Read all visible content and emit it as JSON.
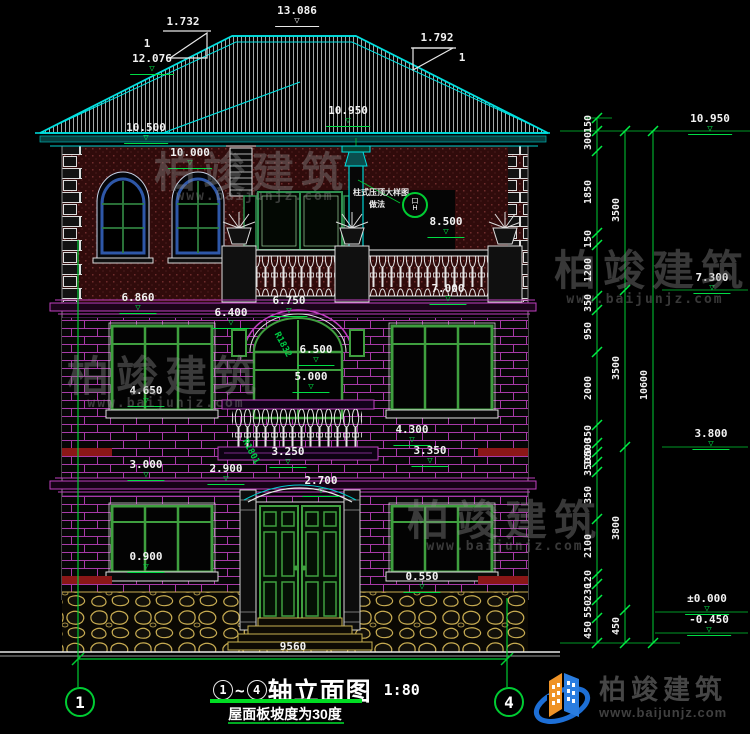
{
  "title": {
    "axis_start": "1",
    "tilde": "~",
    "axis_end": "4",
    "name": "轴立面图",
    "scale": "1:80",
    "subtitle": "屋面板坡度为30度"
  },
  "axis_bubbles": {
    "left": "1",
    "right": "4"
  },
  "watermark": {
    "name": "柏竣建筑",
    "url": "www.baijunjz.com"
  },
  "logo": {
    "name": "柏竣建筑",
    "url": "www.baijunjz.com"
  },
  "note": {
    "line1": "柱式压顶大样图",
    "line2": "做法",
    "bubble_top": "口",
    "bubble_bottom": "H"
  },
  "annotations": [
    {
      "t": "1.732",
      "x": 183,
      "y": 16,
      "c": "dim",
      "n": "slope-ratio-left"
    },
    {
      "t": "1",
      "x": 147,
      "y": 38,
      "c": "dim",
      "n": "slope-one-left"
    },
    {
      "t": "13.086",
      "x": 297,
      "y": 5,
      "c": "elev",
      "m": "w",
      "n": "ridge-elevation"
    },
    {
      "t": "1.792",
      "x": 437,
      "y": 32,
      "c": "dim",
      "n": "slope-ratio-right"
    },
    {
      "t": "1",
      "x": 462,
      "y": 52,
      "c": "dim",
      "n": "slope-one-right"
    },
    {
      "t": "12.076",
      "x": 152,
      "y": 53,
      "c": "elev",
      "n": "roof-elevation"
    },
    {
      "t": "10.950",
      "x": 348,
      "y": 105,
      "c": "elev",
      "n": "eave-elevation"
    },
    {
      "t": "10.500",
      "x": 146,
      "y": 122,
      "c": "elev",
      "n": "eave-elevation"
    },
    {
      "t": "10.000",
      "x": 190,
      "y": 147,
      "c": "elev",
      "n": "wall-top-elevation"
    },
    {
      "t": "8.500",
      "x": 446,
      "y": 216,
      "c": "elev",
      "n": "railing-elevation"
    },
    {
      "t": "7.000",
      "x": 448,
      "y": 283,
      "c": "elev",
      "n": "floor3-elevation"
    },
    {
      "t": "6.860",
      "x": 138,
      "y": 292,
      "c": "elev",
      "n": "cornice-elevation"
    },
    {
      "t": "6.750",
      "x": 289,
      "y": 295,
      "c": "elev",
      "n": "balcony-elevation"
    },
    {
      "t": "6.400",
      "x": 231,
      "y": 307,
      "c": "elev",
      "n": "window-top-elevation"
    },
    {
      "t": "6.500",
      "x": 316,
      "y": 344,
      "c": "elev",
      "n": "arch-elevation"
    },
    {
      "t": "5.000",
      "x": 311,
      "y": 371,
      "c": "elev",
      "n": "window-elevation"
    },
    {
      "t": "4.650",
      "x": 146,
      "y": 385,
      "c": "elev",
      "n": "sill-elevation"
    },
    {
      "t": "4.300",
      "x": 412,
      "y": 424,
      "c": "elev",
      "n": "sill-elevation"
    },
    {
      "t": "3.000",
      "x": 146,
      "y": 459,
      "c": "elev",
      "n": "beam-elevation"
    },
    {
      "t": "2.900",
      "x": 226,
      "y": 463,
      "c": "elev",
      "n": "beam-elevation"
    },
    {
      "t": "3.250",
      "x": 288,
      "y": 446,
      "c": "elev",
      "n": "balcony2-elevation"
    },
    {
      "t": "3.350",
      "x": 430,
      "y": 445,
      "c": "elev",
      "n": "beam-elevation"
    },
    {
      "t": "2.700",
      "x": 321,
      "y": 475,
      "c": "elev",
      "n": "door-arch-elevation"
    },
    {
      "t": "0.900",
      "x": 146,
      "y": 551,
      "c": "elev",
      "n": "sill-elevation"
    },
    {
      "t": "0.550",
      "x": 422,
      "y": 571,
      "c": "elev",
      "n": "sill-elevation"
    },
    {
      "t": "9560",
      "x": 293,
      "y": 641,
      "c": "dim",
      "n": "overall-width-dimension"
    },
    {
      "t": "R1832",
      "x": 282,
      "y": 345,
      "c": "rad",
      "r": 62,
      "n": "arch-radius-label"
    },
    {
      "t": "R1801",
      "x": 250,
      "y": 452,
      "c": "rad",
      "r": 62,
      "n": "arch-radius-label"
    },
    {
      "t": "10.950",
      "x": 710,
      "y": 113,
      "c": "elev",
      "n": "right-level-10950"
    },
    {
      "t": "7.300",
      "x": 712,
      "y": 272,
      "c": "elev",
      "n": "right-level-7300"
    },
    {
      "t": "3.800",
      "x": 711,
      "y": 428,
      "c": "elev",
      "n": "right-level-3800"
    },
    {
      "t": "±0.000",
      "x": 707,
      "y": 593,
      "c": "elev",
      "n": "right-level-zero"
    },
    {
      "t": "-0.450",
      "x": 709,
      "y": 614,
      "c": "elev",
      "n": "right-level-minus450"
    },
    {
      "t": "柏竣建筑",
      "x": 252,
      "y": 152,
      "c": "wm",
      "n": "watermark-text"
    },
    {
      "t": "www.baijunjz.com",
      "x": 255,
      "y": 190,
      "c": "wmu",
      "n": "watermark-url"
    },
    {
      "t": "柏竣建筑",
      "x": 652,
      "y": 250,
      "c": "wm",
      "n": "watermark-text"
    },
    {
      "t": "www.baijunjz.com",
      "x": 645,
      "y": 293,
      "c": "wmu",
      "n": "watermark-url"
    },
    {
      "t": "柏竣建筑",
      "x": 165,
      "y": 356,
      "c": "wm",
      "n": "watermark-text"
    },
    {
      "t": "www.baijunjz.com",
      "x": 166,
      "y": 397,
      "c": "wmu",
      "n": "watermark-url"
    },
    {
      "t": "柏竣建筑",
      "x": 505,
      "y": 500,
      "c": "wm",
      "n": "watermark-text"
    },
    {
      "t": "www.baijunjz.com",
      "x": 505,
      "y": 540,
      "c": "wmu",
      "n": "watermark-url"
    },
    {
      "t": "柱式压顶大样图",
      "x": 381,
      "y": 189,
      "c": "note",
      "n": "detail-note-line1"
    },
    {
      "t": "做法",
      "x": 377,
      "y": 201,
      "c": "note",
      "n": "detail-note-line2"
    }
  ],
  "right_chain": {
    "inner": [
      {
        "v": "150",
        "y": 124
      },
      {
        "v": "300",
        "y": 141
      },
      {
        "v": "1850",
        "y": 192
      },
      {
        "v": "150",
        "y": 239
      },
      {
        "v": "1200",
        "y": 270
      },
      {
        "v": "350",
        "y": 303
      },
      {
        "v": "950",
        "y": 331
      },
      {
        "v": "2000",
        "y": 388
      },
      {
        "v": "350",
        "y": 434
      },
      {
        "v": "500",
        "y": 447
      },
      {
        "v": "100",
        "y": 457
      },
      {
        "v": "350",
        "y": 467
      },
      {
        "v": "350",
        "y": 495
      },
      {
        "v": "2100",
        "y": 546
      },
      {
        "v": "120",
        "y": 579
      },
      {
        "v": "230",
        "y": 592
      },
      {
        "v": "550",
        "y": 609
      },
      {
        "v": "450",
        "y": 630
      }
    ],
    "middle": [
      {
        "v": "3500",
        "y": 210
      },
      {
        "v": "3500",
        "y": 368
      },
      {
        "v": "3800",
        "y": 528
      },
      {
        "v": "450",
        "y": 626
      }
    ],
    "outer": [
      {
        "v": "10600",
        "y": 385
      }
    ]
  },
  "colors": {
    "cyan": "#00e0e0",
    "green": "#00cc33",
    "magenta": "#c040c0",
    "brick_line": "#a83aa8",
    "wall_red": "#300b0b",
    "beam_red": "#8b1717",
    "stone": "#c9ad52",
    "logo_blue": "#2a7de0",
    "logo_orange": "#ef9327"
  }
}
